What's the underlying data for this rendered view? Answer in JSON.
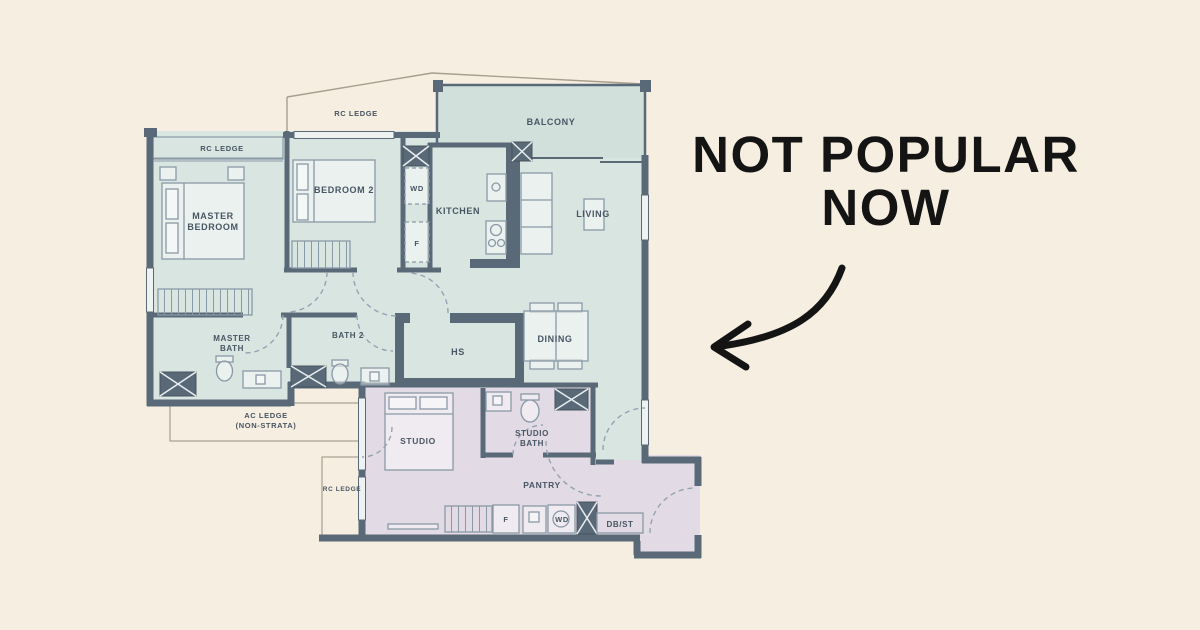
{
  "annotation": {
    "line1": "NOT POPULAR",
    "line2": "NOW",
    "color": "#141414"
  },
  "plan": {
    "labels": {
      "rc_ledge_outer": "RC LEDGE",
      "rc_ledge_master": "RC LEDGE",
      "balcony": "BALCONY",
      "master_bedroom_line1": "MASTER",
      "master_bedroom_line2": "BEDROOM",
      "bedroom2": "BEDROOM 2",
      "wd_kitchen": "WD",
      "f_kitchen": "F",
      "kitchen": "KITCHEN",
      "living": "LIVING",
      "master_bath_line1": "MASTER",
      "master_bath_line2": "BATH",
      "bath2": "BATH 2",
      "hs": "HS",
      "dining": "DINING",
      "ac_ledge_line1": "AC LEDGE",
      "ac_ledge_line2": "(NON-STRATA)",
      "studio": "STUDIO",
      "studio_bath_line1": "STUDIO",
      "studio_bath_line2": "BATH",
      "rc_ledge_lower": "RC LEDGE",
      "pantry": "PANTRY",
      "f_pantry": "F",
      "wd_pantry": "WD",
      "db_st": "DB/ST"
    }
  },
  "colors": {
    "background": "#f6eee1",
    "wall": "#5a6978",
    "wall_dark": "#47535f",
    "unit_fill": "#d9e5e1",
    "balcony_fill": "#d2e0dc",
    "studio_fill": "#e2dae4",
    "furniture_line": "#8a99a7",
    "dashed_line": "#94a3b1",
    "ledge_line": "#a79e8d",
    "label_text": "#475664",
    "annotation": "#141414"
  }
}
